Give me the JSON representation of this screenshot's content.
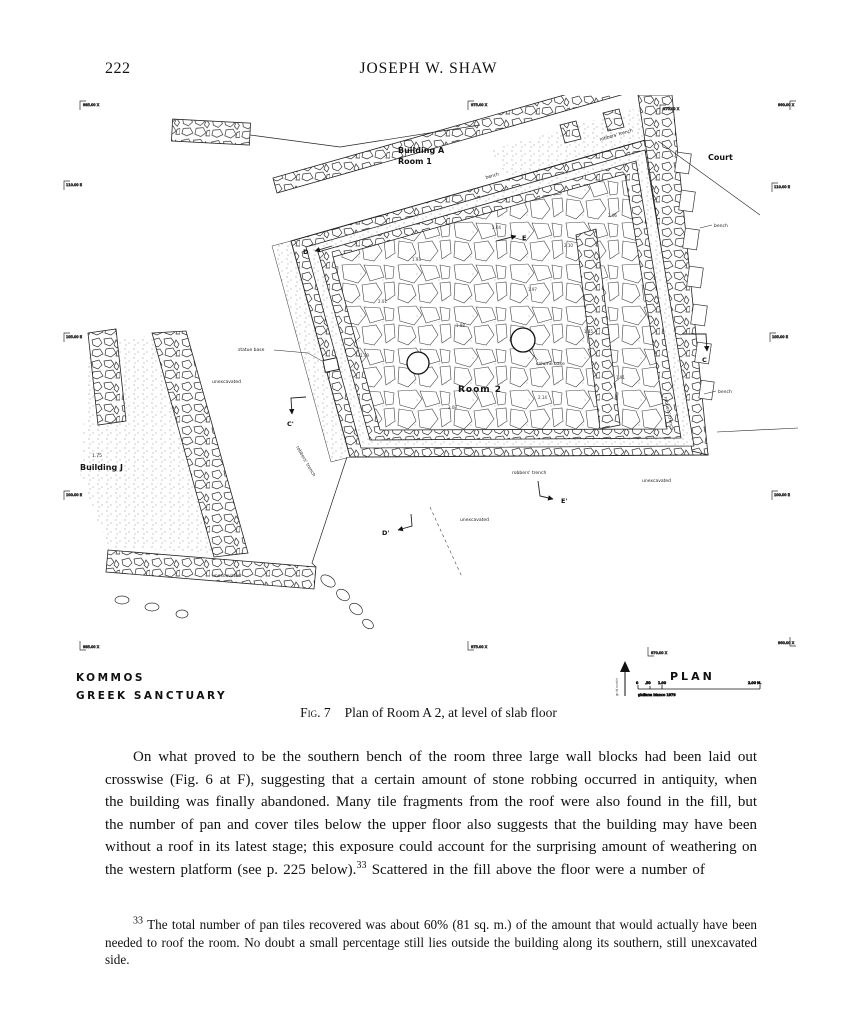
{
  "page": {
    "number": "222",
    "running_head": "JOSEPH W. SHAW"
  },
  "figure": {
    "caption_label": "Fig. 7",
    "caption_text": "Plan of Room A 2, at level of slab floor",
    "plan": {
      "site_line1": "KOMMOS",
      "site_line2": "GREEK SANCTUARY",
      "title": "PLAN",
      "north_label": "grid north",
      "credit": "giuliana bianco 1979",
      "scale": {
        "t0": "0",
        "t1": ".50",
        "t2": "1.00",
        "t3": "2.00 M."
      },
      "labels": {
        "building_a": "Building A",
        "room_1": "Room 1",
        "room_2": "Room 2",
        "court": "Court",
        "building_j": "Building J",
        "bench": "bench",
        "robbers_trench": "robbers' trench",
        "statue_base": "statue base",
        "column_base": "column base",
        "unexcavated": "unexcavated",
        "bj_elev": "1.75"
      },
      "sections": {
        "c": "C",
        "c_prime": "C'",
        "d": "D",
        "d_prime": "D'",
        "e": "E",
        "e_prime": "E'"
      },
      "ticks": [
        "985.00 X",
        "975.00 X",
        "970.00 X",
        "960.00 X",
        "110.00 E",
        "105.00 E",
        "100.00 E",
        "110.00 E",
        "105.00 E",
        "100.00 E",
        "985.00 X",
        "975.00 X",
        "970.00 X",
        "960.00 X"
      ],
      "spots": [
        "2.01",
        "1.93",
        "1.88",
        "2.04",
        "1.97",
        "2.10",
        "1.85",
        "2.06",
        "1.91",
        "2.14",
        "1.79",
        "2.08"
      ]
    }
  },
  "body": {
    "para1": "On what proved to be the southern bench of the room three large wall blocks had been laid out crosswise (Fig. 6 at F), suggesting that a certain amount of stone robbing occurred in antiquity, when the building was finally abandoned. Many tile fragments from the roof were also found in the fill, but the number of pan and cover tiles below the upper floor also suggests that the building may have been without a roof in its latest stage; this exposure could account for the surprising amount of weathering on the western platform (see p. 225 below).",
    "sup": "33",
    "para2": " Scattered in the fill above the floor were a number of"
  },
  "footnote": {
    "marker": "33",
    "text": " The total number of pan tiles recovered was about 60% (81 sq. m.) of the amount that would actually have been needed to roof the room. No doubt a small percentage still lies outside the building along its southern, still unexcavated side."
  }
}
